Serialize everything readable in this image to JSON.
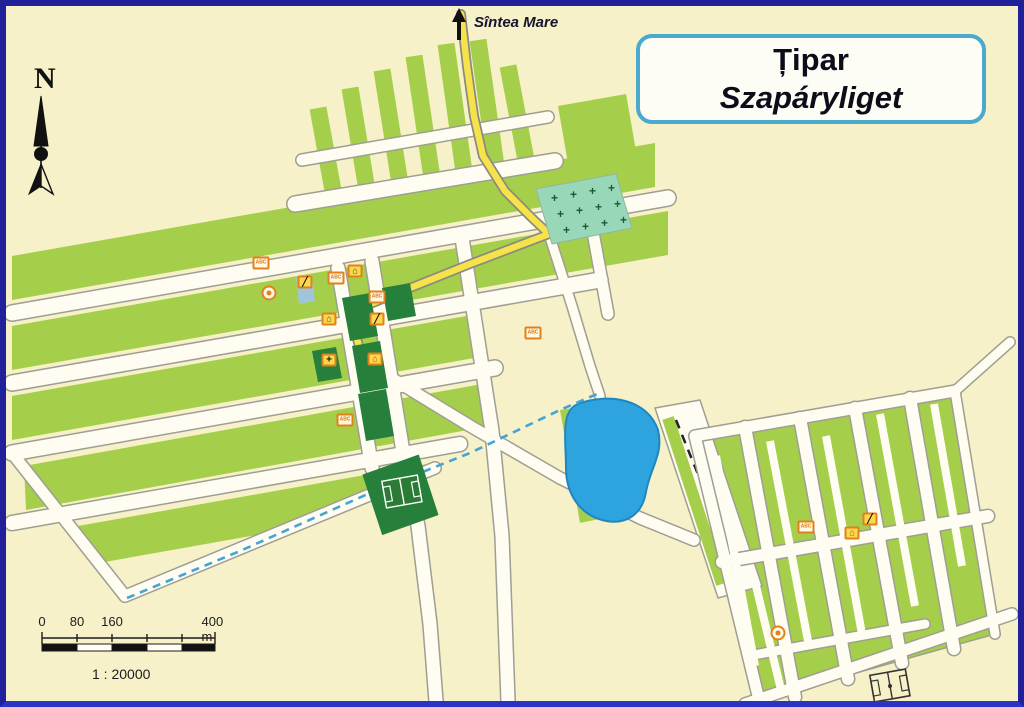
{
  "title": {
    "line1": "Țipar",
    "line2": "Szapáryliget"
  },
  "labels": {
    "north": "N",
    "destination_road": "Sîntea Mare"
  },
  "scale_bar": {
    "tick_labels": [
      "0",
      "80",
      "160",
      "400 m"
    ],
    "ratio": "1 : 20000"
  },
  "colors": {
    "frame_navy": "#20209a",
    "background_cream": "#f6f1c8",
    "plot_green": "#a5cf4b",
    "dark_green": "#26803c",
    "road_white": "#fffdf2",
    "road_casing": "#9e9e92",
    "main_road_yellow": "#f6e24b",
    "lake_blue": "#2ea4de",
    "cemetery_teal": "#98d8b8",
    "canal_dash_blue": "#44a4d4",
    "title_border_blue": "#4aa9cd",
    "poi_orange": "#e2811c",
    "poi_yellow": "#fbd94d"
  },
  "map_features": {
    "lake": "pond",
    "cemetery": "cross-hatched plot",
    "football_fields": 2,
    "canal": "dashed blue boundary ditch",
    "tree_row": "dashed black line"
  },
  "pois": [
    {
      "type": "shop-abc",
      "glyph": "ABC",
      "x": 255,
      "y": 257
    },
    {
      "type": "post-circle",
      "glyph": "dot",
      "x": 263,
      "y": 287
    },
    {
      "type": "pen",
      "glyph": "╱",
      "x": 299,
      "y": 276
    },
    {
      "type": "shop-abc",
      "glyph": "ABC",
      "x": 330,
      "y": 272
    },
    {
      "type": "building",
      "glyph": "⌂",
      "x": 349,
      "y": 265
    },
    {
      "type": "shop-abc",
      "glyph": "ABC",
      "x": 371,
      "y": 291
    },
    {
      "type": "building",
      "glyph": "⌂",
      "x": 323,
      "y": 313
    },
    {
      "type": "pen",
      "glyph": "╱",
      "x": 371,
      "y": 313
    },
    {
      "type": "church",
      "glyph": "+",
      "x": 323,
      "y": 354
    },
    {
      "type": "building-red",
      "glyph": "⌂",
      "x": 369,
      "y": 353
    },
    {
      "type": "shop-abc",
      "glyph": "ABC",
      "x": 339,
      "y": 414
    },
    {
      "type": "shop-abc",
      "glyph": "ABC",
      "x": 527,
      "y": 327
    },
    {
      "type": "shop-abc",
      "glyph": "ABC",
      "x": 800,
      "y": 521
    },
    {
      "type": "building-red",
      "glyph": "⌂",
      "x": 846,
      "y": 527
    },
    {
      "type": "pen",
      "glyph": "╱",
      "x": 864,
      "y": 513
    },
    {
      "type": "post-circle",
      "glyph": "dot",
      "x": 772,
      "y": 627
    }
  ]
}
